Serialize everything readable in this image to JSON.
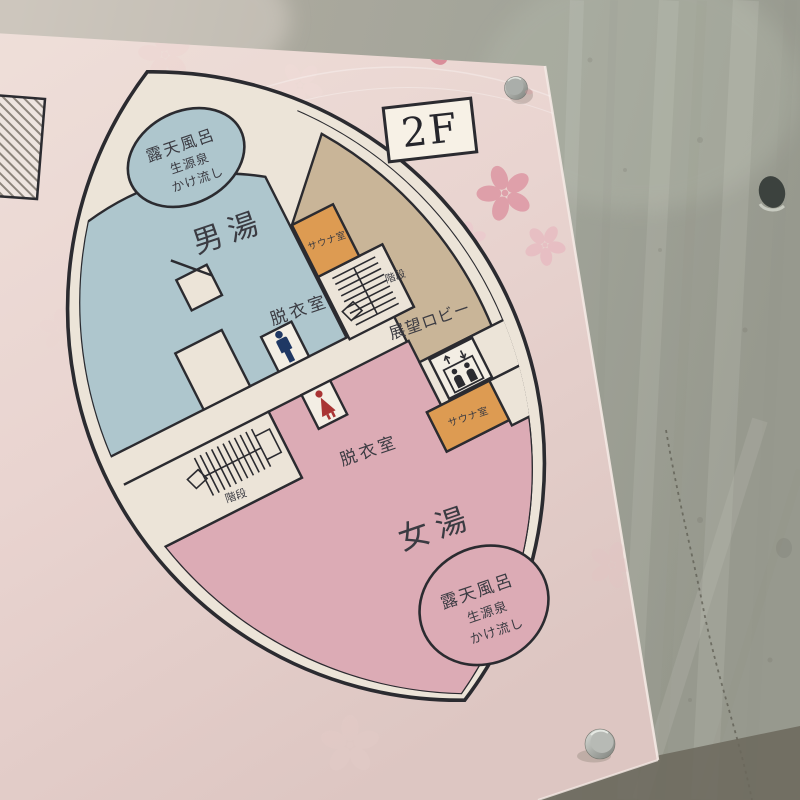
{
  "sign": {
    "floor_badge": "2F",
    "mens_area": {
      "name": "男湯",
      "dressing_room": "脱衣室",
      "sauna": "サウナ室",
      "stairs": "階段",
      "outdoor_bath": {
        "line1": "露天風呂",
        "line2": "生源泉",
        "line3": "かけ流し"
      }
    },
    "womens_area": {
      "name": "女湯",
      "dressing_room": "脱衣室",
      "sauna": "サウナ室",
      "stairs": "階段",
      "outdoor_bath": {
        "line1": "露天風呂",
        "line2": "生源泉",
        "line3": "かけ流し"
      }
    },
    "lobby": {
      "name": "展望ロビー"
    },
    "colors": {
      "mens_zone": "#aec6cd",
      "womens_zone": "#dcabb5",
      "lobby_zone": "#c9b598",
      "sauna_zone": "#dd9b52",
      "plan_line": "#2b2b30",
      "leaf_background": "#ece4d8",
      "sign_background": "#e9d6d2",
      "blossom_pink": "#d6808f",
      "man_icon": "#1f3864",
      "woman_icon": "#a93434",
      "concrete_wall": "#a3a399"
    }
  }
}
